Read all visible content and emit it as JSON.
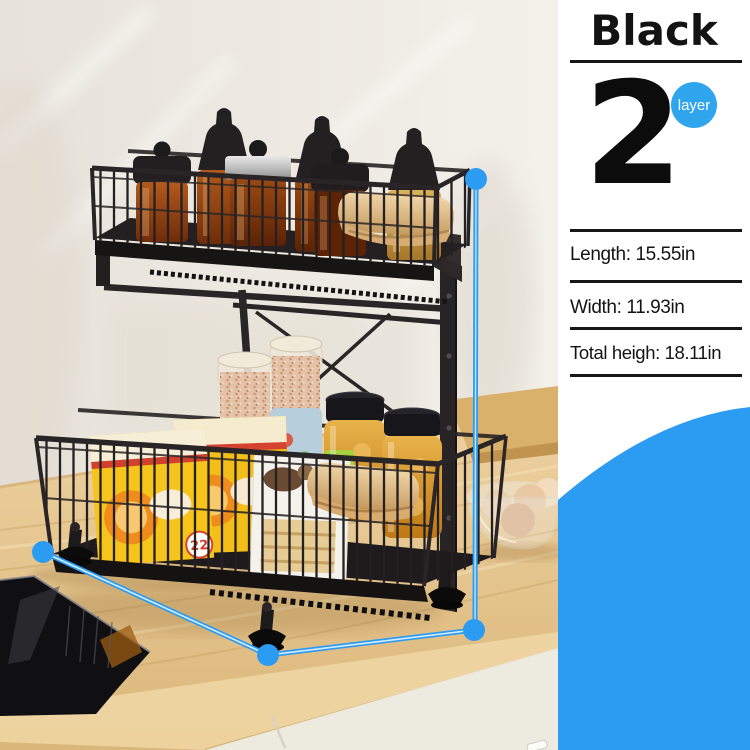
{
  "colors": {
    "accent": "#2b9cf2",
    "badge": "#2fa5ee",
    "panel_text": "#141414",
    "divider": "#171717",
    "rack_black": "#262122",
    "counter_wood": "#e2c28b",
    "wall": "#ece8e1"
  },
  "panel": {
    "color_label": "Black",
    "layer_count": "2",
    "layer_unit": "layer",
    "specs": [
      {
        "name": "length",
        "label": "Length: 15.55in"
      },
      {
        "name": "width",
        "label": "Width: 11.93in"
      },
      {
        "name": "total_height",
        "label": "Total heigh: 18.11in"
      }
    ]
  },
  "photo": {
    "box_badge": "22"
  }
}
